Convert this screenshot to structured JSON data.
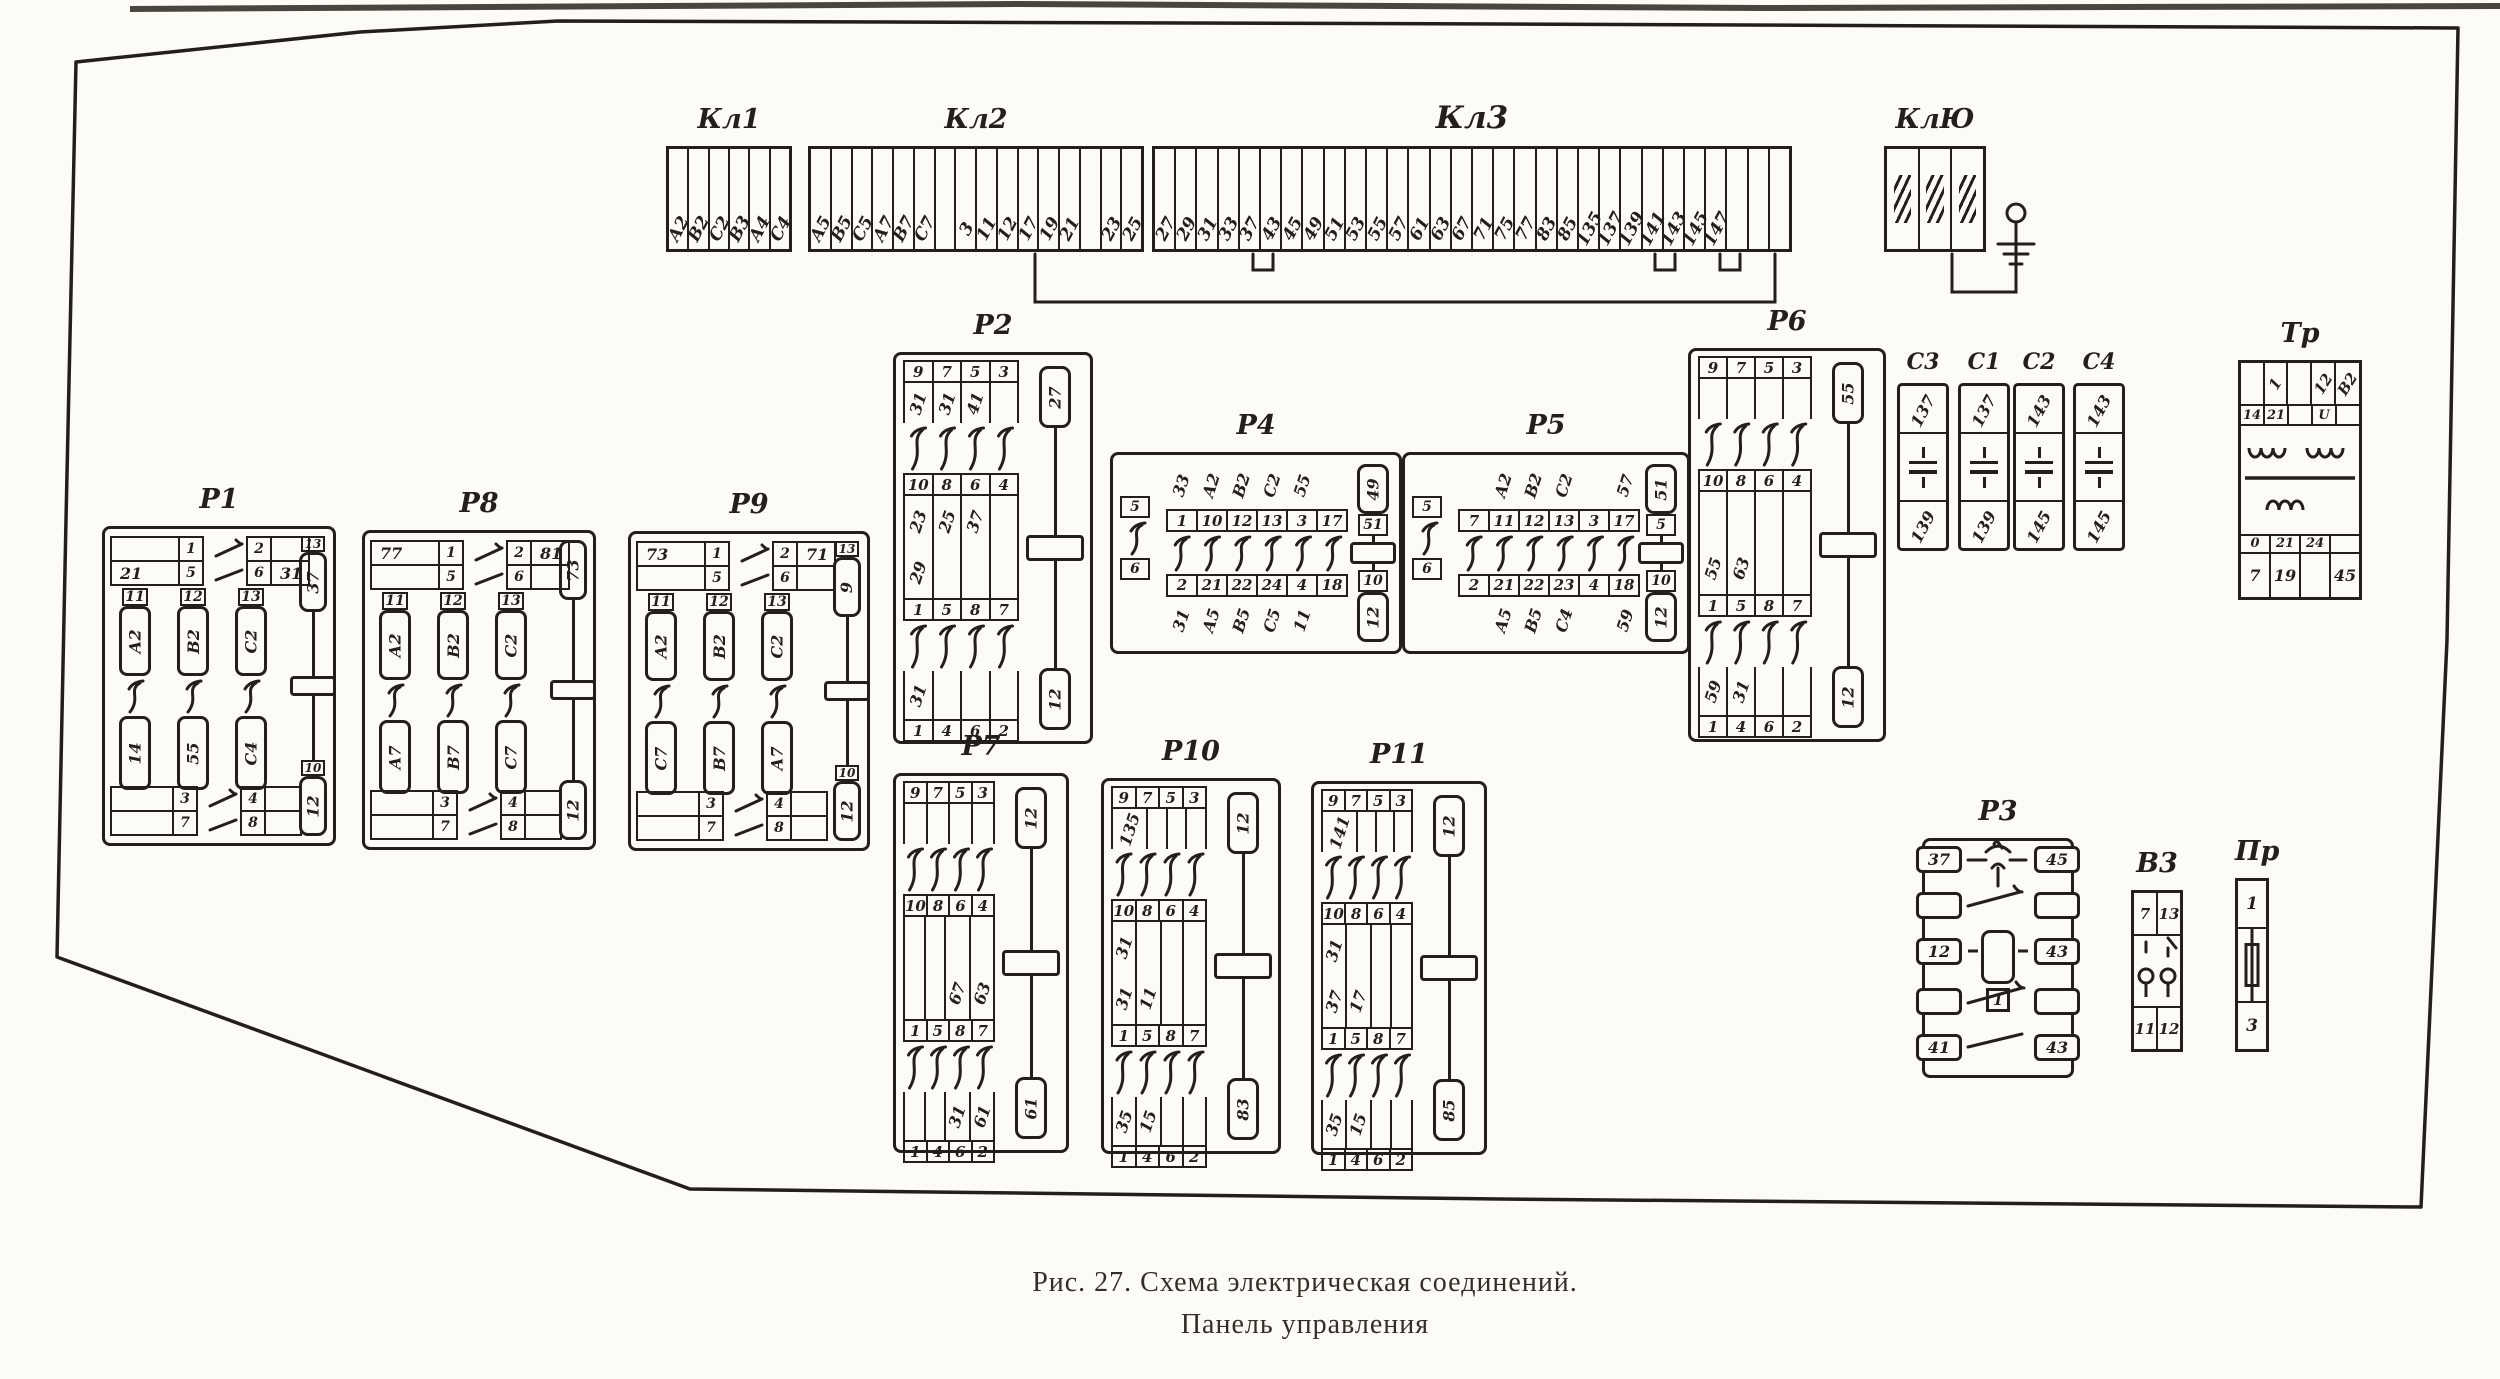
{
  "caption": {
    "line1": "Рис. 27. Схема электрическая соединений.",
    "line2": "Панель управления"
  },
  "colors": {
    "ink": "#241f1a",
    "paper": "#fcfbf6"
  },
  "components": {
    "kl1": {
      "label": "Кл1",
      "type": "strip",
      "cells": [
        "А2",
        "В2",
        "С2",
        "В3",
        "А4",
        "С4"
      ]
    },
    "kl2": {
      "label": "Кл2",
      "type": "strip",
      "cells": [
        "А5",
        "В5",
        "С5",
        "А7",
        "В7",
        "С7",
        "",
        "3",
        "11",
        "12",
        "17",
        "19",
        "21",
        "",
        "23",
        "25"
      ]
    },
    "kl3": {
      "label": "Кл3",
      "type": "strip",
      "cells": [
        "27",
        "29",
        "31",
        "33",
        "37",
        "43",
        "45",
        "49",
        "51",
        "53",
        "55",
        "57",
        "61",
        "63",
        "67",
        "71",
        "75",
        "77",
        "83",
        "85",
        "135",
        "137",
        "139",
        "141",
        "143",
        "145",
        "147",
        "",
        "",
        ""
      ]
    },
    "klyu": {
      "label": "КлЮ",
      "type": "strip",
      "cells": [
        "#g",
        "#g",
        "#g"
      ]
    },
    "r2": {
      "label": "Р2",
      "type": "relay-v",
      "top_cells": [
        "9",
        "7",
        "5",
        "3"
      ],
      "top_wires": [
        "31",
        "31",
        "41",
        ""
      ],
      "mid_top_cells": [
        "10",
        "8",
        "6",
        "4"
      ],
      "mid_wires_top": [
        "23",
        "25",
        "37",
        ""
      ],
      "mid_wires_bottom": [
        "29",
        "",
        "",
        ""
      ],
      "mid_bottom_cells": [
        "1",
        "5",
        "8",
        "7"
      ],
      "low_wires": [
        "31",
        "",
        "",
        ""
      ],
      "low_cells": [
        "1",
        "4",
        "6",
        "2"
      ],
      "coil_top": "27",
      "coil_bottom": "12"
    },
    "r6": {
      "label": "Р6",
      "type": "relay-v",
      "top_cells": [
        "9",
        "7",
        "5",
        "3"
      ],
      "top_wires": [
        "",
        "",
        "",
        ""
      ],
      "mid_top_cells": [
        "10",
        "8",
        "6",
        "4"
      ],
      "mid_wires_top": [
        "",
        "",
        "",
        ""
      ],
      "mid_wires_bottom": [
        "55",
        "63",
        "",
        ""
      ],
      "mid_bottom_cells": [
        "1",
        "5",
        "8",
        "7"
      ],
      "low_wires": [
        "59",
        "31",
        "",
        ""
      ],
      "low_cells": [
        "1",
        "4",
        "6",
        "2"
      ],
      "coil_top": "55",
      "coil_bottom": "12"
    },
    "r7": {
      "label": "Р7",
      "type": "relay-v",
      "top_cells": [
        "9",
        "7",
        "5",
        "3"
      ],
      "top_wires": [
        "",
        "",
        "",
        ""
      ],
      "mid_top_cells": [
        "10",
        "8",
        "6",
        "4"
      ],
      "mid_wires_top": [
        "",
        "",
        "",
        ""
      ],
      "mid_wires_bottom": [
        "",
        "",
        "67",
        "63"
      ],
      "mid_bottom_cells": [
        "1",
        "5",
        "8",
        "7"
      ],
      "low_wires": [
        "",
        "",
        "31",
        "61"
      ],
      "low_cells": [
        "1",
        "4",
        "6",
        "2"
      ],
      "coil_top": "12",
      "coil_bottom": "61"
    },
    "r10": {
      "label": "Р10",
      "type": "relay-v",
      "top_cells": [
        "9",
        "7",
        "5",
        "3"
      ],
      "top_wires": [
        "135",
        "",
        "",
        ""
      ],
      "mid_top_cells": [
        "10",
        "8",
        "6",
        "4"
      ],
      "mid_wires_top": [
        "31",
        "",
        "",
        ""
      ],
      "mid_wires_bottom": [
        "31",
        "11",
        "",
        ""
      ],
      "mid_bottom_cells": [
        "1",
        "5",
        "8",
        "7"
      ],
      "low_wires": [
        "35",
        "15",
        "",
        ""
      ],
      "low_cells": [
        "1",
        "4",
        "6",
        "2"
      ],
      "coil_top": "12",
      "coil_bottom": "83"
    },
    "r11": {
      "label": "Р11",
      "type": "relay-v",
      "top_cells": [
        "9",
        "7",
        "5",
        "3"
      ],
      "top_wires": [
        "141",
        "",
        "",
        ""
      ],
      "mid_top_cells": [
        "10",
        "8",
        "6",
        "4"
      ],
      "mid_wires_top": [
        "31",
        "",
        "",
        ""
      ],
      "mid_wires_bottom": [
        "37",
        "17",
        "",
        ""
      ],
      "mid_bottom_cells": [
        "1",
        "5",
        "8",
        "7"
      ],
      "low_wires": [
        "35",
        "15",
        "",
        ""
      ],
      "low_cells": [
        "1",
        "4",
        "6",
        "2"
      ],
      "coil_top": "12",
      "coil_bottom": "85"
    },
    "r4": {
      "label": "Р4",
      "type": "relay-h",
      "left_top": "5",
      "left_bottom": "6",
      "top_wires": [
        "33",
        "А2",
        "В2",
        "С2",
        "55",
        ""
      ],
      "top_cells": [
        "1",
        "10",
        "12",
        "13",
        "3",
        "17"
      ],
      "bottom_cells": [
        "2",
        "21",
        "22",
        "24",
        "4",
        "18"
      ],
      "bottom_wires": [
        "31",
        "А5",
        "В5",
        "С5",
        "11",
        ""
      ],
      "coil_top_wire": "49",
      "coil_top": "51",
      "coil_bottom": "10",
      "coil_bottom_wire": "12"
    },
    "r5": {
      "label": "Р5",
      "type": "relay-h",
      "left_top": "5",
      "left_bottom": "6",
      "top_wires": [
        "",
        "А2",
        "В2",
        "С2",
        "",
        "57"
      ],
      "top_cells": [
        "7",
        "11",
        "12",
        "13",
        "3",
        "17"
      ],
      "bottom_cells": [
        "2",
        "21",
        "22",
        "23",
        "4",
        "18"
      ],
      "bottom_wires": [
        "",
        "А5",
        "В5",
        "С4",
        "",
        "59"
      ],
      "coil_top_wire": "51",
      "coil_top": "5",
      "coil_bottom": "10",
      "coil_bottom_wire": "12"
    },
    "r1": {
      "label": "Р1",
      "type": "relay-ph",
      "tl_rows": [
        "",
        "21"
      ],
      "tl_cells": [
        "1",
        "5"
      ],
      "tr_cells": [
        "2",
        "6"
      ],
      "tr_rows": [
        "",
        "31"
      ],
      "phases": [
        {
          "cell": "11",
          "top": "А2",
          "bottom": "14"
        },
        {
          "cell": "12",
          "top": "В2",
          "bottom": "55"
        },
        {
          "cell": "13",
          "top": "С2",
          "bottom": "С4"
        }
      ],
      "bl_cells": [
        "3",
        "7"
      ],
      "br_cells": [
        "4",
        "8"
      ],
      "coil_top_cell": "13",
      "coil_top": "37",
      "coil_bottom_cell": "10",
      "coil_bottom": "12"
    },
    "r8": {
      "label": "Р8",
      "type": "relay-ph",
      "tl_rows": [
        "77",
        ""
      ],
      "tl_cells": [
        "1",
        "5"
      ],
      "tr_cells": [
        "2",
        "6"
      ],
      "tr_rows": [
        "81",
        ""
      ],
      "phases": [
        {
          "cell": "11",
          "top": "А2",
          "bottom": "А7"
        },
        {
          "cell": "12",
          "top": "В2",
          "bottom": "В7"
        },
        {
          "cell": "13",
          "top": "С2",
          "bottom": "С7"
        }
      ],
      "bl_cells": [
        "3",
        "7"
      ],
      "br_cells": [
        "4",
        "8"
      ],
      "coil_top_cell": "",
      "coil_top": "73",
      "coil_bottom_cell": "",
      "coil_bottom": "12"
    },
    "r9": {
      "label": "Р9",
      "type": "relay-ph",
      "tl_rows": [
        "73",
        ""
      ],
      "tl_cells": [
        "1",
        "5"
      ],
      "tr_cells": [
        "2",
        "6"
      ],
      "tr_rows": [
        "71",
        ""
      ],
      "phases": [
        {
          "cell": "11",
          "top": "А2",
          "bottom": "С7"
        },
        {
          "cell": "12",
          "top": "В2",
          "bottom": "В7"
        },
        {
          "cell": "13",
          "top": "С2",
          "bottom": "А7"
        }
      ],
      "bl_cells": [
        "3",
        "7"
      ],
      "br_cells": [
        "4",
        "8"
      ],
      "coil_top_cell": "13",
      "coil_top": "9",
      "coil_bottom_cell": "10",
      "coil_bottom": "12"
    },
    "c3": {
      "label": "С3",
      "type": "capacitor",
      "top": "137",
      "bottom": "139"
    },
    "c1": {
      "label": "С1",
      "type": "capacitor",
      "top": "137",
      "bottom": "139"
    },
    "c2": {
      "label": "С2",
      "type": "capacitor",
      "top": "143",
      "bottom": "145"
    },
    "c4": {
      "label": "С4",
      "type": "capacitor",
      "top": "143",
      "bottom": "145"
    },
    "tr": {
      "label": "Тр",
      "type": "transformer",
      "top_cells": [
        "",
        "1",
        "",
        "12",
        "В2"
      ],
      "top_sub": [
        "14",
        "21",
        "",
        "U",
        ""
      ],
      "bottom_sub": [
        "0",
        "21",
        "24",
        ""
      ],
      "bottom_cells": [
        "7",
        "19",
        "",
        "45"
      ]
    },
    "r3": {
      "label": "Р3",
      "type": "relay-r3",
      "left": [
        "37",
        "",
        "12",
        "",
        "41"
      ],
      "right": [
        "45",
        "",
        "43",
        "",
        "43"
      ],
      "coil": "1"
    },
    "v3": {
      "label": "В3",
      "type": "switch",
      "top_cells": [
        "7",
        "13"
      ],
      "bottom_cells": [
        "11",
        "12"
      ]
    },
    "pr": {
      "label": "Пр",
      "type": "fuse",
      "top": "1",
      "bottom": "3"
    }
  }
}
